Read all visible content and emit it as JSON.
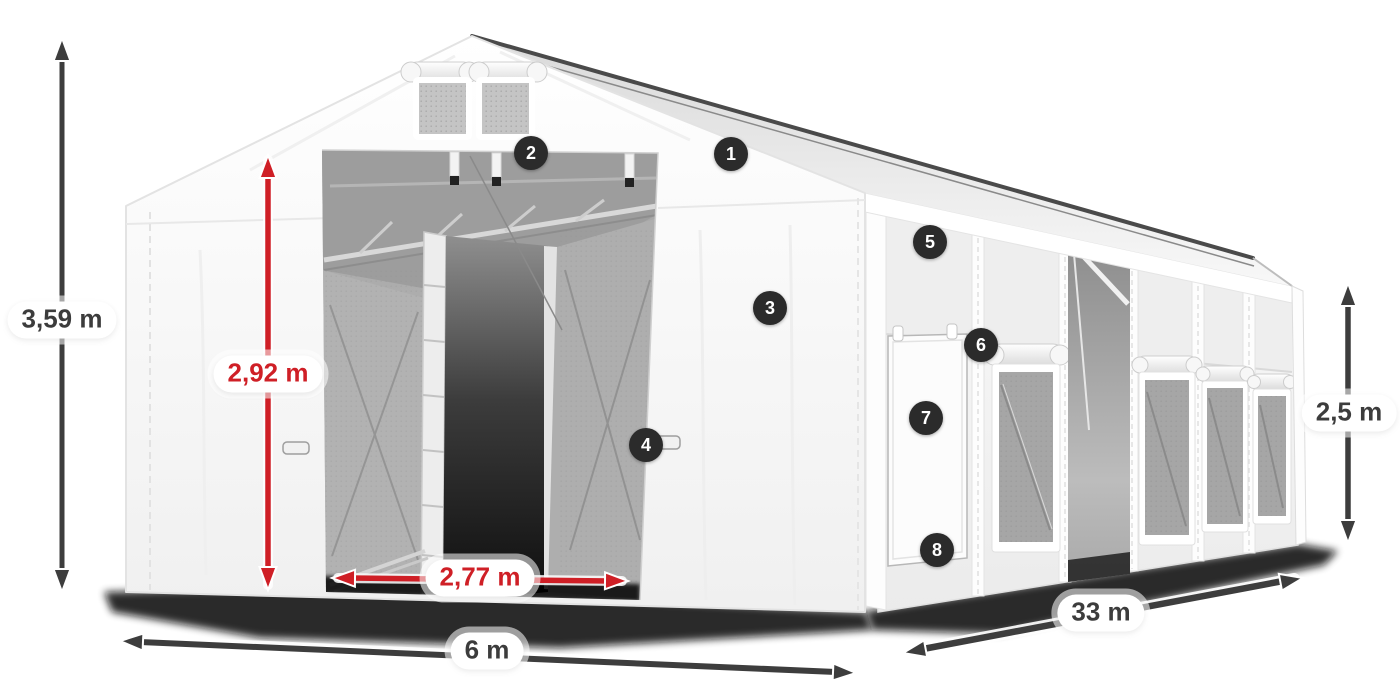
{
  "diagram": {
    "subject": "storage-tent-dimension-diagram",
    "colors": {
      "dimension_dark": "#3d3d3d",
      "dimension_red": "#cf1f26",
      "badge_background": "#2b2b2b",
      "tent_white": "#ffffff"
    }
  },
  "dimensions": {
    "total_height": {
      "label": "3,59 m"
    },
    "entrance_height": {
      "label": "2,92 m"
    },
    "entrance_width": {
      "label": "2,77 m"
    },
    "total_width": {
      "label": "6 m"
    },
    "total_length": {
      "label": "33 m"
    },
    "side_height": {
      "label": "2,5 m"
    }
  },
  "callouts": [
    {
      "number": "1"
    },
    {
      "number": "2"
    },
    {
      "number": "3"
    },
    {
      "number": "4"
    },
    {
      "number": "5"
    },
    {
      "number": "6"
    },
    {
      "number": "7"
    },
    {
      "number": "8"
    }
  ]
}
